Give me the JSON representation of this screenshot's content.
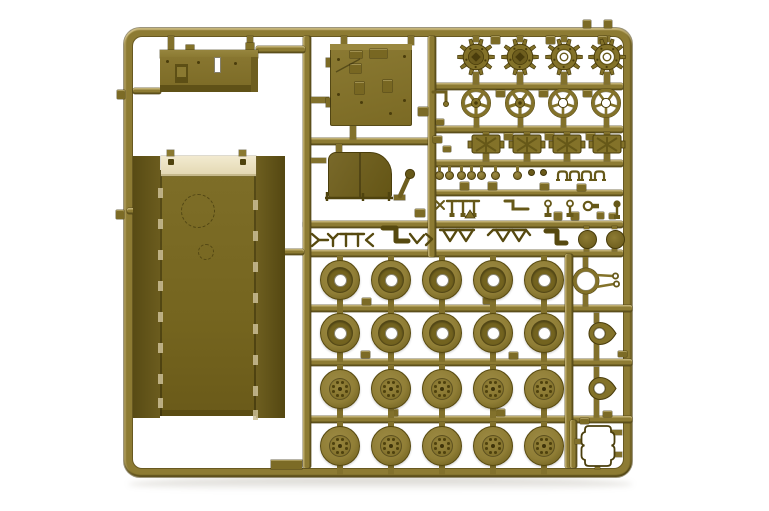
{
  "meta": {
    "label": "Olive-drab plastic model kit parts sprue photographed on a white background"
  },
  "inventory": {
    "drive_sprockets": 4,
    "idler_wheels": 4,
    "fuel_cans": 4,
    "road_wheels": 20,
    "hull_tub": 1,
    "roof_panel": 1,
    "storage_box": 1,
    "engine_hood": 1,
    "leaf_springs": 6,
    "headlights": 7,
    "tow_shackle_ring": 1,
    "hatch_eyelets": 2,
    "frame_gasket": 1
  },
  "palette": {
    "railFill": "#8d7b33",
    "partMid": "#837229",
    "partLight": "#9c8a46",
    "partDark": "#665818",
    "partDeep": "#4a3d0c",
    "cream": "#ece3c3",
    "creamEdge": "#c6b98c",
    "hole": "#ffffff",
    "wheelFace": "#907e36",
    "wheelDonut": "#6f5f1e",
    "shadow": "rgba(110,102,80,0.4)"
  },
  "frame": {
    "x": 124,
    "y": 28,
    "w": 508,
    "h": 449,
    "t": 9,
    "r": 16
  },
  "rails": [
    [
      307,
      138,
      127,
      7,
      "h"
    ],
    [
      432,
      83,
      191,
      7,
      "h"
    ],
    [
      432,
      126,
      191,
      7,
      "h"
    ],
    [
      432,
      160,
      191,
      7,
      "h"
    ],
    [
      432,
      190,
      191,
      6,
      "h"
    ],
    [
      303,
      221,
      320,
      7,
      "h"
    ],
    [
      303,
      250,
      320,
      7,
      "h"
    ],
    [
      307,
      305,
      325,
      7,
      "h"
    ],
    [
      307,
      359,
      325,
      7,
      "h"
    ],
    [
      307,
      416,
      325,
      7,
      "h"
    ],
    [
      303,
      36,
      8,
      432,
      "v"
    ],
    [
      428,
      36,
      8,
      221,
      "v"
    ],
    [
      565,
      254,
      8,
      214,
      "v"
    ],
    [
      570,
      420,
      7,
      48,
      "v"
    ],
    [
      256,
      46,
      49,
      7,
      "h"
    ],
    [
      133,
      88,
      28,
      6,
      "h"
    ],
    [
      127,
      208,
      8,
      6,
      "h"
    ],
    [
      283,
      249,
      21,
      6,
      "h"
    ]
  ],
  "stems": [
    [
      168,
      36,
      6,
      15
    ],
    [
      247,
      36,
      6,
      9
    ],
    [
      341,
      36,
      6,
      9
    ],
    [
      408,
      36,
      6,
      9
    ],
    [
      311,
      97,
      18,
      6
    ],
    [
      350,
      125,
      6,
      14
    ],
    [
      336,
      144,
      6,
      9
    ],
    [
      311,
      158,
      15,
      5
    ],
    [
      473,
      36,
      6,
      6
    ],
    [
      517,
      36,
      6,
      6
    ],
    [
      561,
      36,
      6,
      6
    ],
    [
      604,
      36,
      6,
      6
    ],
    [
      473,
      72,
      6,
      12
    ],
    [
      517,
      72,
      6,
      12
    ],
    [
      561,
      72,
      6,
      12
    ],
    [
      604,
      72,
      6,
      12
    ],
    [
      474,
      116,
      5,
      11
    ],
    [
      518,
      116,
      5,
      11
    ],
    [
      561,
      116,
      5,
      11
    ],
    [
      604,
      116,
      5,
      11
    ],
    [
      483,
      150,
      6,
      11
    ],
    [
      524,
      150,
      6,
      11
    ],
    [
      564,
      150,
      6,
      11
    ],
    [
      604,
      150,
      6,
      11
    ],
    [
      483,
      132,
      6,
      3
    ],
    [
      524,
      132,
      6,
      3
    ],
    [
      564,
      132,
      6,
      3
    ],
    [
      604,
      132,
      6,
      3
    ],
    [
      583,
      257,
      5,
      14
    ],
    [
      583,
      291,
      5,
      15
    ],
    [
      594,
      313,
      5,
      10
    ],
    [
      594,
      342,
      5,
      18
    ],
    [
      594,
      367,
      5,
      12
    ],
    [
      594,
      398,
      5,
      19
    ],
    [
      584,
      247,
      5,
      4
    ],
    [
      612,
      247,
      5,
      4
    ],
    [
      584,
      226,
      5,
      3
    ],
    [
      612,
      226,
      5,
      3
    ],
    [
      575,
      439,
      9,
      5
    ],
    [
      612,
      430,
      10,
      5
    ],
    [
      612,
      452,
      10,
      5
    ],
    [
      595,
      461,
      5,
      8
    ]
  ],
  "tabs": [
    [
      491,
      36,
      9,
      8
    ],
    [
      546,
      36,
      9,
      8
    ],
    [
      598,
      36,
      9,
      8
    ],
    [
      583,
      20,
      8,
      8
    ],
    [
      604,
      20,
      8,
      8
    ],
    [
      117,
      90,
      8,
      9
    ],
    [
      116,
      210,
      8,
      9
    ],
    [
      496,
      90,
      9,
      7
    ],
    [
      539,
      90,
      9,
      7
    ],
    [
      583,
      90,
      9,
      7
    ],
    [
      504,
      133,
      9,
      7
    ],
    [
      545,
      133,
      9,
      7
    ],
    [
      586,
      133,
      9,
      7
    ],
    [
      460,
      182,
      9,
      8
    ],
    [
      488,
      182,
      9,
      8
    ],
    [
      540,
      183,
      9,
      7
    ],
    [
      577,
      184,
      9,
      7
    ],
    [
      554,
      212,
      8,
      8
    ],
    [
      571,
      212,
      8,
      8
    ],
    [
      597,
      212,
      7,
      7
    ],
    [
      609,
      213,
      7,
      6
    ],
    [
      362,
      298,
      9,
      7
    ],
    [
      483,
      297,
      9,
      7
    ],
    [
      361,
      351,
      9,
      7
    ],
    [
      509,
      352,
      9,
      7
    ],
    [
      496,
      409,
      9,
      7
    ],
    [
      389,
      409,
      9,
      7
    ],
    [
      618,
      351,
      9,
      6
    ],
    [
      580,
      418,
      9,
      6
    ],
    [
      603,
      411,
      9,
      6
    ],
    [
      418,
      107,
      10,
      9
    ],
    [
      436,
      119,
      8,
      6
    ],
    [
      433,
      136,
      9,
      7
    ],
    [
      443,
      146,
      8,
      6
    ],
    [
      415,
      209,
      10,
      8
    ]
  ],
  "box_part": {
    "bumps": [
      [
        186,
        45,
        8,
        6
      ],
      [
        246,
        43,
        8,
        7
      ]
    ],
    "top": [
      160,
      50,
      98,
      8
    ],
    "face": [
      160,
      57,
      98,
      30
    ],
    "bottom": [
      160,
      85,
      98,
      7
    ],
    "right": [
      251,
      57,
      7,
      35
    ],
    "slot": [
      214,
      57,
      7,
      16
    ],
    "bracket": [
      175,
      64,
      13,
      19
    ],
    "bracket_inner": [
      177,
      67,
      9,
      10
    ],
    "dots": [
      [
        234,
        62
      ],
      [
        197,
        61
      ],
      [
        166,
        60
      ]
    ]
  },
  "panel": {
    "body": [
      330,
      44,
      82,
      82
    ],
    "top": [
      330,
      44,
      82,
      6
    ],
    "details": [
      [
        350,
        51,
        12,
        7
      ],
      [
        370,
        49,
        17,
        9
      ],
      [
        350,
        64,
        11,
        9
      ],
      [
        355,
        82,
        9,
        12
      ],
      [
        383,
        80,
        9,
        12
      ]
    ],
    "bumps": [
      [
        326,
        58,
        4,
        9
      ],
      [
        326,
        98,
        4,
        9
      ]
    ],
    "dots": [
      [
        337,
        58
      ],
      [
        337,
        93
      ],
      [
        403,
        55
      ],
      [
        403,
        99
      ],
      [
        389,
        112
      ],
      [
        360,
        101
      ]
    ]
  },
  "hull": {
    "left": [
      133,
      156,
      27,
      262
    ],
    "right": [
      256,
      156,
      29,
      262
    ],
    "center": [
      160,
      170,
      96,
      246
    ],
    "lip": [
      160,
      410,
      96,
      6
    ],
    "cream": [
      161,
      156,
      95,
      20
    ],
    "bolts": [
      [
        168,
        159,
        6,
        6
      ],
      [
        240,
        159,
        6,
        6
      ]
    ],
    "tabs": [
      [
        167,
        150,
        7,
        6
      ],
      [
        239,
        150,
        7,
        6
      ]
    ],
    "circle_big": [
      198,
      211,
      17
    ],
    "circle_small": [
      206,
      252,
      8
    ],
    "notch_ys": [
      188,
      219,
      250,
      281,
      312,
      343,
      374,
      398
    ]
  },
  "fender": {
    "body": [
      328,
      152,
      64,
      46
    ]
  },
  "sprockets": {
    "y": 57,
    "xs": [
      476,
      520,
      564,
      607
    ],
    "open": [
      false,
      false,
      true,
      true
    ]
  },
  "idlers": {
    "y": 103,
    "xs": [
      476,
      520,
      563,
      606
    ],
    "open": [
      false,
      false,
      true,
      true
    ]
  },
  "cans": {
    "y": 134,
    "xs": [
      486,
      527,
      567,
      607
    ]
  },
  "lamps": {
    "y": 175,
    "xs": [
      439,
      449,
      461,
      471,
      481,
      495,
      517
    ],
    "beads": [
      531,
      543
    ],
    "clamps": [
      556,
      568,
      580,
      593
    ]
  },
  "pins": {
    "tposts": [
      452,
      463,
      474
    ],
    "ringpins": [
      548,
      570
    ],
    "ballpin": 617,
    "key": [
      588,
      206
    ],
    "star": [
      440,
      205
    ],
    "tri": [
      470,
      214
    ],
    "srod": [
      [
        505,
        201
      ],
      [
        513,
        201
      ],
      [
        513,
        209
      ],
      [
        528,
        209
      ]
    ]
  },
  "springs": [
    {
      "w": 2.4,
      "pts": [
        [
          312,
          234
        ],
        [
          319,
          240
        ],
        [
          312,
          246
        ]
      ]
    },
    {
      "w": 2.4,
      "pts": [
        [
          319,
          240
        ],
        [
          328,
          240
        ]
      ]
    },
    {
      "w": 2.4,
      "pts": [
        [
          328,
          234
        ],
        [
          333,
          239
        ],
        [
          338,
          234
        ]
      ]
    },
    {
      "w": 2.4,
      "pts": [
        [
          333,
          239
        ],
        [
          333,
          246
        ]
      ]
    },
    {
      "w": 2.4,
      "pts": [
        [
          340,
          234
        ],
        [
          352,
          234
        ]
      ]
    },
    {
      "w": 2.4,
      "pts": [
        [
          346,
          234
        ],
        [
          346,
          246
        ]
      ]
    },
    {
      "w": 2.4,
      "pts": [
        [
          352,
          234
        ],
        [
          364,
          234
        ]
      ]
    },
    {
      "w": 2.4,
      "pts": [
        [
          358,
          234
        ],
        [
          358,
          246
        ]
      ]
    },
    {
      "w": 2.4,
      "pts": [
        [
          373,
          234
        ],
        [
          366,
          240
        ],
        [
          373,
          246
        ]
      ]
    },
    {
      "w": 5,
      "pts": [
        [
          383,
          228
        ],
        [
          396,
          228
        ],
        [
          396,
          241
        ],
        [
          408,
          241
        ]
      ]
    },
    {
      "w": 2.4,
      "pts": [
        [
          410,
          234
        ],
        [
          417,
          243
        ],
        [
          424,
          235
        ]
      ]
    },
    {
      "w": 2.4,
      "pts": [
        [
          426,
          234
        ],
        [
          432,
          239
        ],
        [
          426,
          245
        ]
      ]
    },
    {
      "w": 2.4,
      "pts": [
        [
          440,
          230
        ],
        [
          474,
          230
        ]
      ]
    },
    {
      "w": 2.4,
      "pts": [
        [
          443,
          230
        ],
        [
          450,
          241
        ],
        [
          457,
          230
        ]
      ]
    },
    {
      "w": 2.4,
      "pts": [
        [
          459,
          230
        ],
        [
          466,
          241
        ],
        [
          473,
          230
        ]
      ]
    },
    {
      "w": 2.4,
      "pts": [
        [
          488,
          235
        ],
        [
          493,
          230
        ],
        [
          526,
          230
        ],
        [
          530,
          235
        ]
      ]
    },
    {
      "w": 2.4,
      "pts": [
        [
          496,
          230
        ],
        [
          503,
          241
        ],
        [
          510,
          230
        ]
      ]
    },
    {
      "w": 2.4,
      "pts": [
        [
          512,
          230
        ],
        [
          519,
          241
        ],
        [
          526,
          230
        ]
      ]
    },
    {
      "w": 5,
      "pts": [
        [
          546,
          231
        ],
        [
          557,
          231
        ],
        [
          557,
          243
        ],
        [
          566,
          243
        ]
      ]
    }
  ],
  "hook": {
    "pts": [
      [
        433,
        92
      ],
      [
        446,
        92
      ],
      [
        446,
        102
      ]
    ],
    "ball": [
      446,
      104
    ]
  },
  "lever": {
    "rod": [
      [
        400,
        196
      ],
      [
        409,
        176
      ]
    ],
    "pulley": [
      410,
      174
    ],
    "foot": [
      394,
      195,
      11,
      5
    ]
  },
  "axle": {
    "bar": [
      [
        325,
        198
      ],
      [
        393,
        198
      ]
    ],
    "feet": [
      [
        327,
        192
      ],
      [
        327,
        201
      ],
      [
        363,
        193
      ],
      [
        363,
        201
      ],
      [
        389,
        192
      ],
      [
        389,
        201
      ]
    ]
  },
  "wheels": {
    "cols": [
      340,
      391,
      442,
      493,
      544
    ],
    "rows": [
      {
        "y": 280,
        "t": "A"
      },
      {
        "y": 333,
        "t": "A"
      },
      {
        "y": 389,
        "t": "B"
      },
      {
        "y": 446,
        "t": "B"
      }
    ],
    "r": 20
  },
  "ring": {
    "cx": 586,
    "cy": 281
  },
  "teardrops": [
    [
      599,
      333
    ],
    [
      599,
      388
    ]
  ],
  "discs": [
    [
      587,
      239
    ],
    [
      615,
      239
    ]
  ],
  "clover": {
    "cx": 598,
    "cy": 446
  },
  "bottom_tab": [
    271,
    460,
    31,
    9
  ],
  "shadow": {
    "x": 128,
    "y": 477,
    "w": 505,
    "h": 14
  }
}
